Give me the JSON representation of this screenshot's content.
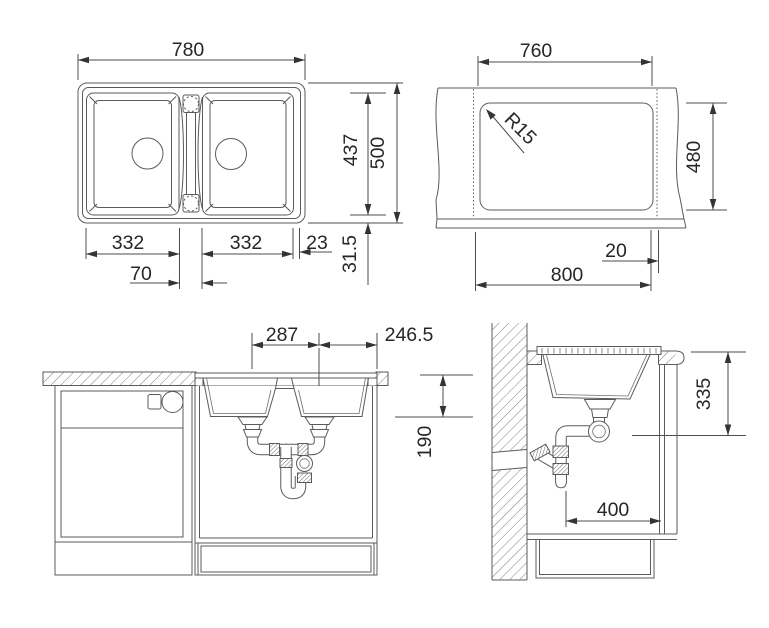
{
  "colors": {
    "background": "#ffffff",
    "line": "#5b5b5b",
    "text": "#262626"
  },
  "views": {
    "top_view": {
      "overall_width": "780",
      "inner_depth": "437",
      "overall_depth": "500",
      "left_bowl_width": "332",
      "right_bowl_width": "332",
      "right_edge": "23",
      "center_web": "70",
      "bottom_edge": "31.5"
    },
    "cutout_view": {
      "cutout_width": "760",
      "corner_radius": "R15",
      "cutout_depth": "480",
      "edge_gap": "20",
      "cabinet_min_width": "800"
    },
    "front_view": {
      "drain_spacing": "287",
      "drain_to_edge": "246.5",
      "bowl_depth": "190"
    },
    "side_view": {
      "install_height": "335",
      "wall_clearance": "400"
    }
  }
}
